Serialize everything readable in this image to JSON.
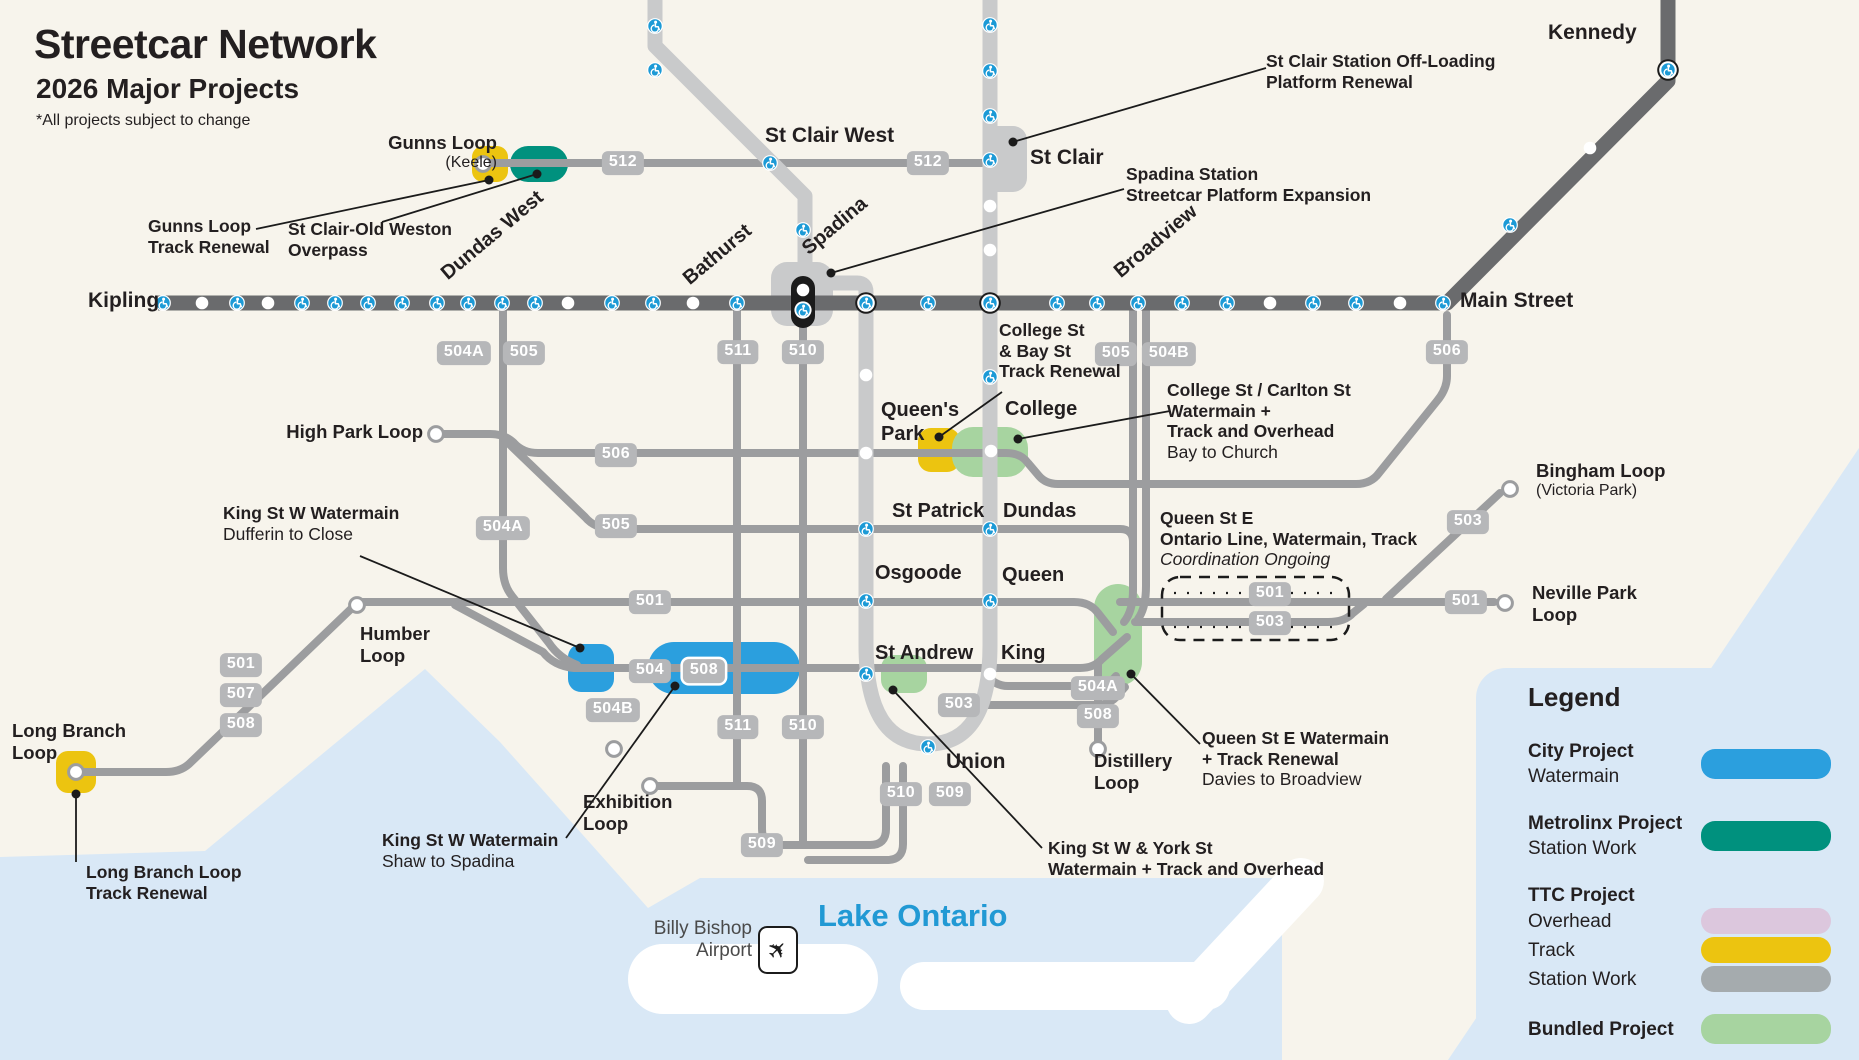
{
  "title": {
    "main": "Streetcar Network",
    "sub": "2026 Major Projects",
    "note": "*All projects subject to change"
  },
  "colors": {
    "background": "#F7F4EC",
    "water": "#D9E8F6",
    "panel": "#D9E8F6",
    "subway_line1": "#C9CACB",
    "subway_line2": "#6A6B6D",
    "streetcar": "#9C9D9F",
    "badge": "#B6B7B9",
    "city_blue": "#2B9FDE",
    "metrolinx_teal": "#00917E",
    "ttc_overhead": "#DCC7DD",
    "ttc_track": "#ECC410",
    "ttc_station": "#A5ABAE",
    "bundled_green": "#A7D4A0",
    "accessibility_blue": "#1C9AD6",
    "lake_text": "#2199D4"
  },
  "legend": {
    "title": "Legend",
    "city": {
      "title": "City Project",
      "sub": "Watermain"
    },
    "metrolinx": {
      "title": "Metrolinx Project",
      "sub": "Station Work"
    },
    "ttc": {
      "title": "TTC Project",
      "row1": "Overhead",
      "row2": "Track",
      "row3": "Station Work"
    },
    "bundled": {
      "title": "Bundled Project"
    }
  },
  "badges": [
    {
      "name": "badge-512-west",
      "x": 623,
      "y": 163,
      "text": "512"
    },
    {
      "name": "badge-512-east",
      "x": 928,
      "y": 163,
      "text": "512"
    },
    {
      "name": "badge-504a-north",
      "x": 464,
      "y": 353,
      "text": "504A"
    },
    {
      "name": "badge-505-north",
      "x": 524,
      "y": 353,
      "text": "505"
    },
    {
      "name": "badge-511-north",
      "x": 738,
      "y": 352,
      "text": "511"
    },
    {
      "name": "badge-510-north",
      "x": 803,
      "y": 352,
      "text": "510"
    },
    {
      "name": "badge-505-east",
      "x": 1116,
      "y": 354,
      "text": "505"
    },
    {
      "name": "badge-504b-east",
      "x": 1169,
      "y": 354,
      "text": "504B"
    },
    {
      "name": "badge-506-east",
      "x": 1447,
      "y": 352,
      "text": "506"
    },
    {
      "name": "badge-506-west",
      "x": 616,
      "y": 455,
      "text": "506"
    },
    {
      "name": "badge-505-west",
      "x": 616,
      "y": 526,
      "text": "505"
    },
    {
      "name": "badge-504a-west",
      "x": 503,
      "y": 528,
      "text": "504A"
    },
    {
      "name": "badge-501-lakeshore",
      "x": 241,
      "y": 665,
      "text": "501"
    },
    {
      "name": "badge-507-lakeshore",
      "x": 241,
      "y": 695,
      "text": "507"
    },
    {
      "name": "badge-508-lakeshore",
      "x": 241,
      "y": 725,
      "text": "508"
    },
    {
      "name": "badge-501-queen",
      "x": 650,
      "y": 602,
      "text": "501"
    },
    {
      "name": "badge-504-king",
      "x": 650,
      "y": 671,
      "text": "504"
    },
    {
      "name": "badge-508-king",
      "x": 704,
      "y": 671,
      "text": "508",
      "outlined": true
    },
    {
      "name": "badge-504b-south",
      "x": 613,
      "y": 710,
      "text": "504B"
    },
    {
      "name": "badge-511-south",
      "x": 738,
      "y": 727,
      "text": "511"
    },
    {
      "name": "badge-510-south",
      "x": 803,
      "y": 727,
      "text": "510"
    },
    {
      "name": "badge-503-king",
      "x": 959,
      "y": 705,
      "text": "503"
    },
    {
      "name": "badge-504a-distillery",
      "x": 1098,
      "y": 688,
      "text": "504A"
    },
    {
      "name": "badge-508-distillery",
      "x": 1098,
      "y": 716,
      "text": "508"
    },
    {
      "name": "badge-510-union",
      "x": 901,
      "y": 794,
      "text": "510"
    },
    {
      "name": "badge-509-union",
      "x": 950,
      "y": 794,
      "text": "509"
    },
    {
      "name": "badge-509-west",
      "x": 762,
      "y": 845,
      "text": "509"
    },
    {
      "name": "badge-501-dashed",
      "x": 1270,
      "y": 594,
      "text": "501"
    },
    {
      "name": "badge-503-dashed",
      "x": 1270,
      "y": 623,
      "text": "503"
    },
    {
      "name": "badge-503-bingham",
      "x": 1468,
      "y": 522,
      "text": "503"
    },
    {
      "name": "badge-501-neville",
      "x": 1466,
      "y": 602,
      "text": "501"
    }
  ],
  "labels": [
    {
      "n": "map-title",
      "x": 34,
      "y": 20,
      "cls": "t-title",
      "lines": [
        {
          "t": "Streetcar Network",
          "c": "b"
        }
      ]
    },
    {
      "n": "map-subtitle",
      "x": 36,
      "y": 72,
      "cls": "t-sub",
      "lines": [
        {
          "t": "2026 Major Projects",
          "c": "b"
        }
      ]
    },
    {
      "n": "map-note",
      "x": 36,
      "y": 112,
      "cls": "t-note",
      "lines": [
        {
          "t": "*All projects subject to change",
          "c": "r"
        }
      ]
    },
    {
      "n": "gunns-loop-label",
      "x": 497,
      "y": 132,
      "cls": "t-loop ra",
      "lines": [
        {
          "t": "Gunns Loop",
          "c": "b"
        },
        {
          "t": "(Keele)",
          "c": "r sm"
        }
      ]
    },
    {
      "n": "gunns-loop-track-renewal",
      "x": 148,
      "y": 216,
      "cls": "t-proj",
      "lines": [
        {
          "t": "Gunns Loop",
          "c": "b"
        },
        {
          "t": "Track Renewal",
          "c": "b"
        }
      ]
    },
    {
      "n": "st-clair-old-weston-overpass",
      "x": 288,
      "y": 219,
      "cls": "t-proj",
      "lines": [
        {
          "t": "St Clair-Old Weston",
          "c": "b"
        },
        {
          "t": "Overpass",
          "c": "b"
        }
      ]
    },
    {
      "n": "st-clair-west-label",
      "x": 765,
      "y": 124,
      "cls": "t-stn",
      "lines": [
        {
          "t": "St Clair West",
          "c": "b"
        }
      ]
    },
    {
      "n": "st-clair-label",
      "x": 1030,
      "y": 146,
      "cls": "t-stn",
      "lines": [
        {
          "t": "St Clair",
          "c": "b"
        }
      ]
    },
    {
      "n": "kennedy-label",
      "x": 1548,
      "y": 21,
      "cls": "t-stn",
      "lines": [
        {
          "t": "Kennedy",
          "c": "b"
        }
      ]
    },
    {
      "n": "st-clair-offloading",
      "x": 1266,
      "y": 51,
      "cls": "t-proj",
      "lines": [
        {
          "t": "St Clair Station Off-Loading",
          "c": "b"
        },
        {
          "t": "Platform Renewal",
          "c": "b"
        }
      ]
    },
    {
      "n": "spadina-station-expansion",
      "x": 1126,
      "y": 164,
      "cls": "t-proj",
      "lines": [
        {
          "t": "Spadina Station",
          "c": "b"
        },
        {
          "t": "Streetcar Platform Expansion",
          "c": "b"
        }
      ]
    },
    {
      "n": "kipling-label",
      "x": 88,
      "y": 289,
      "cls": "t-stn",
      "lines": [
        {
          "t": "Kipling",
          "c": "b"
        }
      ]
    },
    {
      "n": "dundas-west-label",
      "x": 452,
      "y": 262,
      "cls": "t-stn-sm rot",
      "lines": [
        {
          "t": "Dundas West",
          "c": "b"
        }
      ]
    },
    {
      "n": "bathurst-label",
      "x": 694,
      "y": 267,
      "cls": "t-stn-sm rot",
      "lines": [
        {
          "t": "Bathurst",
          "c": "b"
        }
      ]
    },
    {
      "n": "spadina-label",
      "x": 813,
      "y": 237,
      "cls": "t-stn-sm rot",
      "lines": [
        {
          "t": "Spadina",
          "c": "b"
        }
      ]
    },
    {
      "n": "broadview-label",
      "x": 1125,
      "y": 260,
      "cls": "t-stn-sm rot",
      "lines": [
        {
          "t": "Broadview",
          "c": "b"
        }
      ]
    },
    {
      "n": "main-street-label",
      "x": 1460,
      "y": 289,
      "cls": "t-stn",
      "lines": [
        {
          "t": "Main Street",
          "c": "b"
        }
      ]
    },
    {
      "n": "college-bay-track-renewal",
      "x": 999,
      "y": 320,
      "cls": "t-proj",
      "lines": [
        {
          "t": "College St",
          "c": "b"
        },
        {
          "t": "& Bay St",
          "c": "b"
        },
        {
          "t": "Track Renewal",
          "c": "b"
        }
      ]
    },
    {
      "n": "queens-park-label",
      "x": 881,
      "y": 399,
      "cls": "t-stn-sm",
      "lines": [
        {
          "t": "Queen's",
          "c": "b"
        },
        {
          "t": "Park",
          "c": "b"
        }
      ]
    },
    {
      "n": "college-label",
      "x": 1005,
      "y": 398,
      "cls": "t-stn-sm",
      "lines": [
        {
          "t": "College",
          "c": "b"
        }
      ]
    },
    {
      "n": "college-carlton-watermain",
      "x": 1167,
      "y": 380,
      "cls": "t-proj",
      "lines": [
        {
          "t": "College St / Carlton St",
          "c": "b"
        },
        {
          "t": "Watermain +",
          "c": "b"
        },
        {
          "t": "Track and Overhead",
          "c": "b"
        },
        {
          "t": "Bay to Church",
          "c": "r"
        }
      ]
    },
    {
      "n": "st-patrick-label",
      "x": 892,
      "y": 500,
      "cls": "t-stn-sm",
      "lines": [
        {
          "t": "St Patrick",
          "c": "b"
        }
      ]
    },
    {
      "n": "dundas-label",
      "x": 1003,
      "y": 500,
      "cls": "t-stn-sm",
      "lines": [
        {
          "t": "Dundas",
          "c": "b"
        }
      ]
    },
    {
      "n": "osgoode-label",
      "x": 875,
      "y": 562,
      "cls": "t-stn-sm",
      "lines": [
        {
          "t": "Osgoode",
          "c": "b"
        }
      ]
    },
    {
      "n": "queen-label",
      "x": 1002,
      "y": 564,
      "cls": "t-stn-sm",
      "lines": [
        {
          "t": "Queen",
          "c": "b"
        }
      ]
    },
    {
      "n": "st-andrew-label",
      "x": 875,
      "y": 642,
      "cls": "t-stn-sm",
      "lines": [
        {
          "t": "St Andrew",
          "c": "b"
        }
      ]
    },
    {
      "n": "king-label",
      "x": 1001,
      "y": 642,
      "cls": "t-stn-sm",
      "lines": [
        {
          "t": "King",
          "c": "b"
        }
      ]
    },
    {
      "n": "union-label",
      "x": 946,
      "y": 750,
      "cls": "t-stn",
      "lines": [
        {
          "t": "Union",
          "c": "b"
        }
      ]
    },
    {
      "n": "queen-st-e-ontario-line",
      "x": 1160,
      "y": 508,
      "cls": "t-proj",
      "lines": [
        {
          "t": "Queen St E",
          "c": "b"
        },
        {
          "t": "Ontario Line, Watermain, Track",
          "c": "b"
        },
        {
          "t": "Coordination Ongoing",
          "c": "i"
        }
      ]
    },
    {
      "n": "high-park-loop-label",
      "x": 423,
      "y": 421,
      "cls": "t-loop ra",
      "lines": [
        {
          "t": "High Park Loop",
          "c": "b"
        }
      ]
    },
    {
      "n": "king-w-watermain-dufferin",
      "x": 223,
      "y": 503,
      "cls": "t-proj",
      "lines": [
        {
          "t": "King St W Watermain",
          "c": "b"
        },
        {
          "t": "Dufferin to Close",
          "c": "r"
        }
      ]
    },
    {
      "n": "humber-loop-label",
      "x": 360,
      "y": 623,
      "cls": "t-loop",
      "lines": [
        {
          "t": "Humber",
          "c": "b"
        },
        {
          "t": "Loop",
          "c": "b"
        }
      ]
    },
    {
      "n": "long-branch-loop-label",
      "x": 12,
      "y": 720,
      "cls": "t-loop",
      "lines": [
        {
          "t": "Long Branch",
          "c": "b"
        },
        {
          "t": "Loop",
          "c": "b"
        }
      ]
    },
    {
      "n": "long-branch-track-renewal",
      "x": 86,
      "y": 862,
      "cls": "t-proj",
      "lines": [
        {
          "t": "Long Branch Loop",
          "c": "b"
        },
        {
          "t": "Track Renewal",
          "c": "b"
        }
      ]
    },
    {
      "n": "exhibition-loop-label",
      "x": 583,
      "y": 791,
      "cls": "t-loop",
      "lines": [
        {
          "t": "Exhibition",
          "c": "b"
        },
        {
          "t": "Loop",
          "c": "b"
        }
      ]
    },
    {
      "n": "king-w-watermain-shaw",
      "x": 382,
      "y": 830,
      "cls": "t-proj",
      "lines": [
        {
          "t": "King St W Watermain",
          "c": "b"
        },
        {
          "t": "Shaw to Spadina",
          "c": "r"
        }
      ]
    },
    {
      "n": "king-york-watermain",
      "x": 1048,
      "y": 838,
      "cls": "t-proj",
      "lines": [
        {
          "t": "King St W & York St",
          "c": "b"
        },
        {
          "t": "Watermain + Track and Overhead",
          "c": "b"
        }
      ]
    },
    {
      "n": "distillery-loop-label",
      "x": 1094,
      "y": 750,
      "cls": "t-loop",
      "lines": [
        {
          "t": "Distillery",
          "c": "b"
        },
        {
          "t": "Loop",
          "c": "b"
        }
      ]
    },
    {
      "n": "queen-e-watermain-track",
      "x": 1202,
      "y": 728,
      "cls": "t-proj",
      "lines": [
        {
          "t": "Queen St E Watermain",
          "c": "b"
        },
        {
          "t": "+ Track Renewal",
          "c": "b"
        },
        {
          "t": "Davies to Broadview",
          "c": "r"
        }
      ]
    },
    {
      "n": "bingham-loop-label",
      "x": 1536,
      "y": 460,
      "cls": "t-loop",
      "lines": [
        {
          "t": "Bingham Loop",
          "c": "b"
        },
        {
          "t": "(Victoria Park)",
          "c": "r sm"
        }
      ]
    },
    {
      "n": "neville-park-loop-label",
      "x": 1532,
      "y": 582,
      "cls": "t-loop",
      "lines": [
        {
          "t": "Neville Park",
          "c": "b"
        },
        {
          "t": "Loop",
          "c": "b"
        }
      ]
    },
    {
      "n": "lake-ontario-label",
      "x": 818,
      "y": 898,
      "cls": "t-lake",
      "lines": [
        {
          "t": "Lake Ontario",
          "c": "b"
        }
      ]
    },
    {
      "n": "billy-bishop-label",
      "x": 752,
      "y": 918,
      "cls": "t-air ra",
      "lines": [
        {
          "t": "Billy Bishop",
          "c": "r"
        },
        {
          "t": "Airport",
          "c": "r"
        }
      ]
    }
  ],
  "airport_icon_glyph": "✈"
}
